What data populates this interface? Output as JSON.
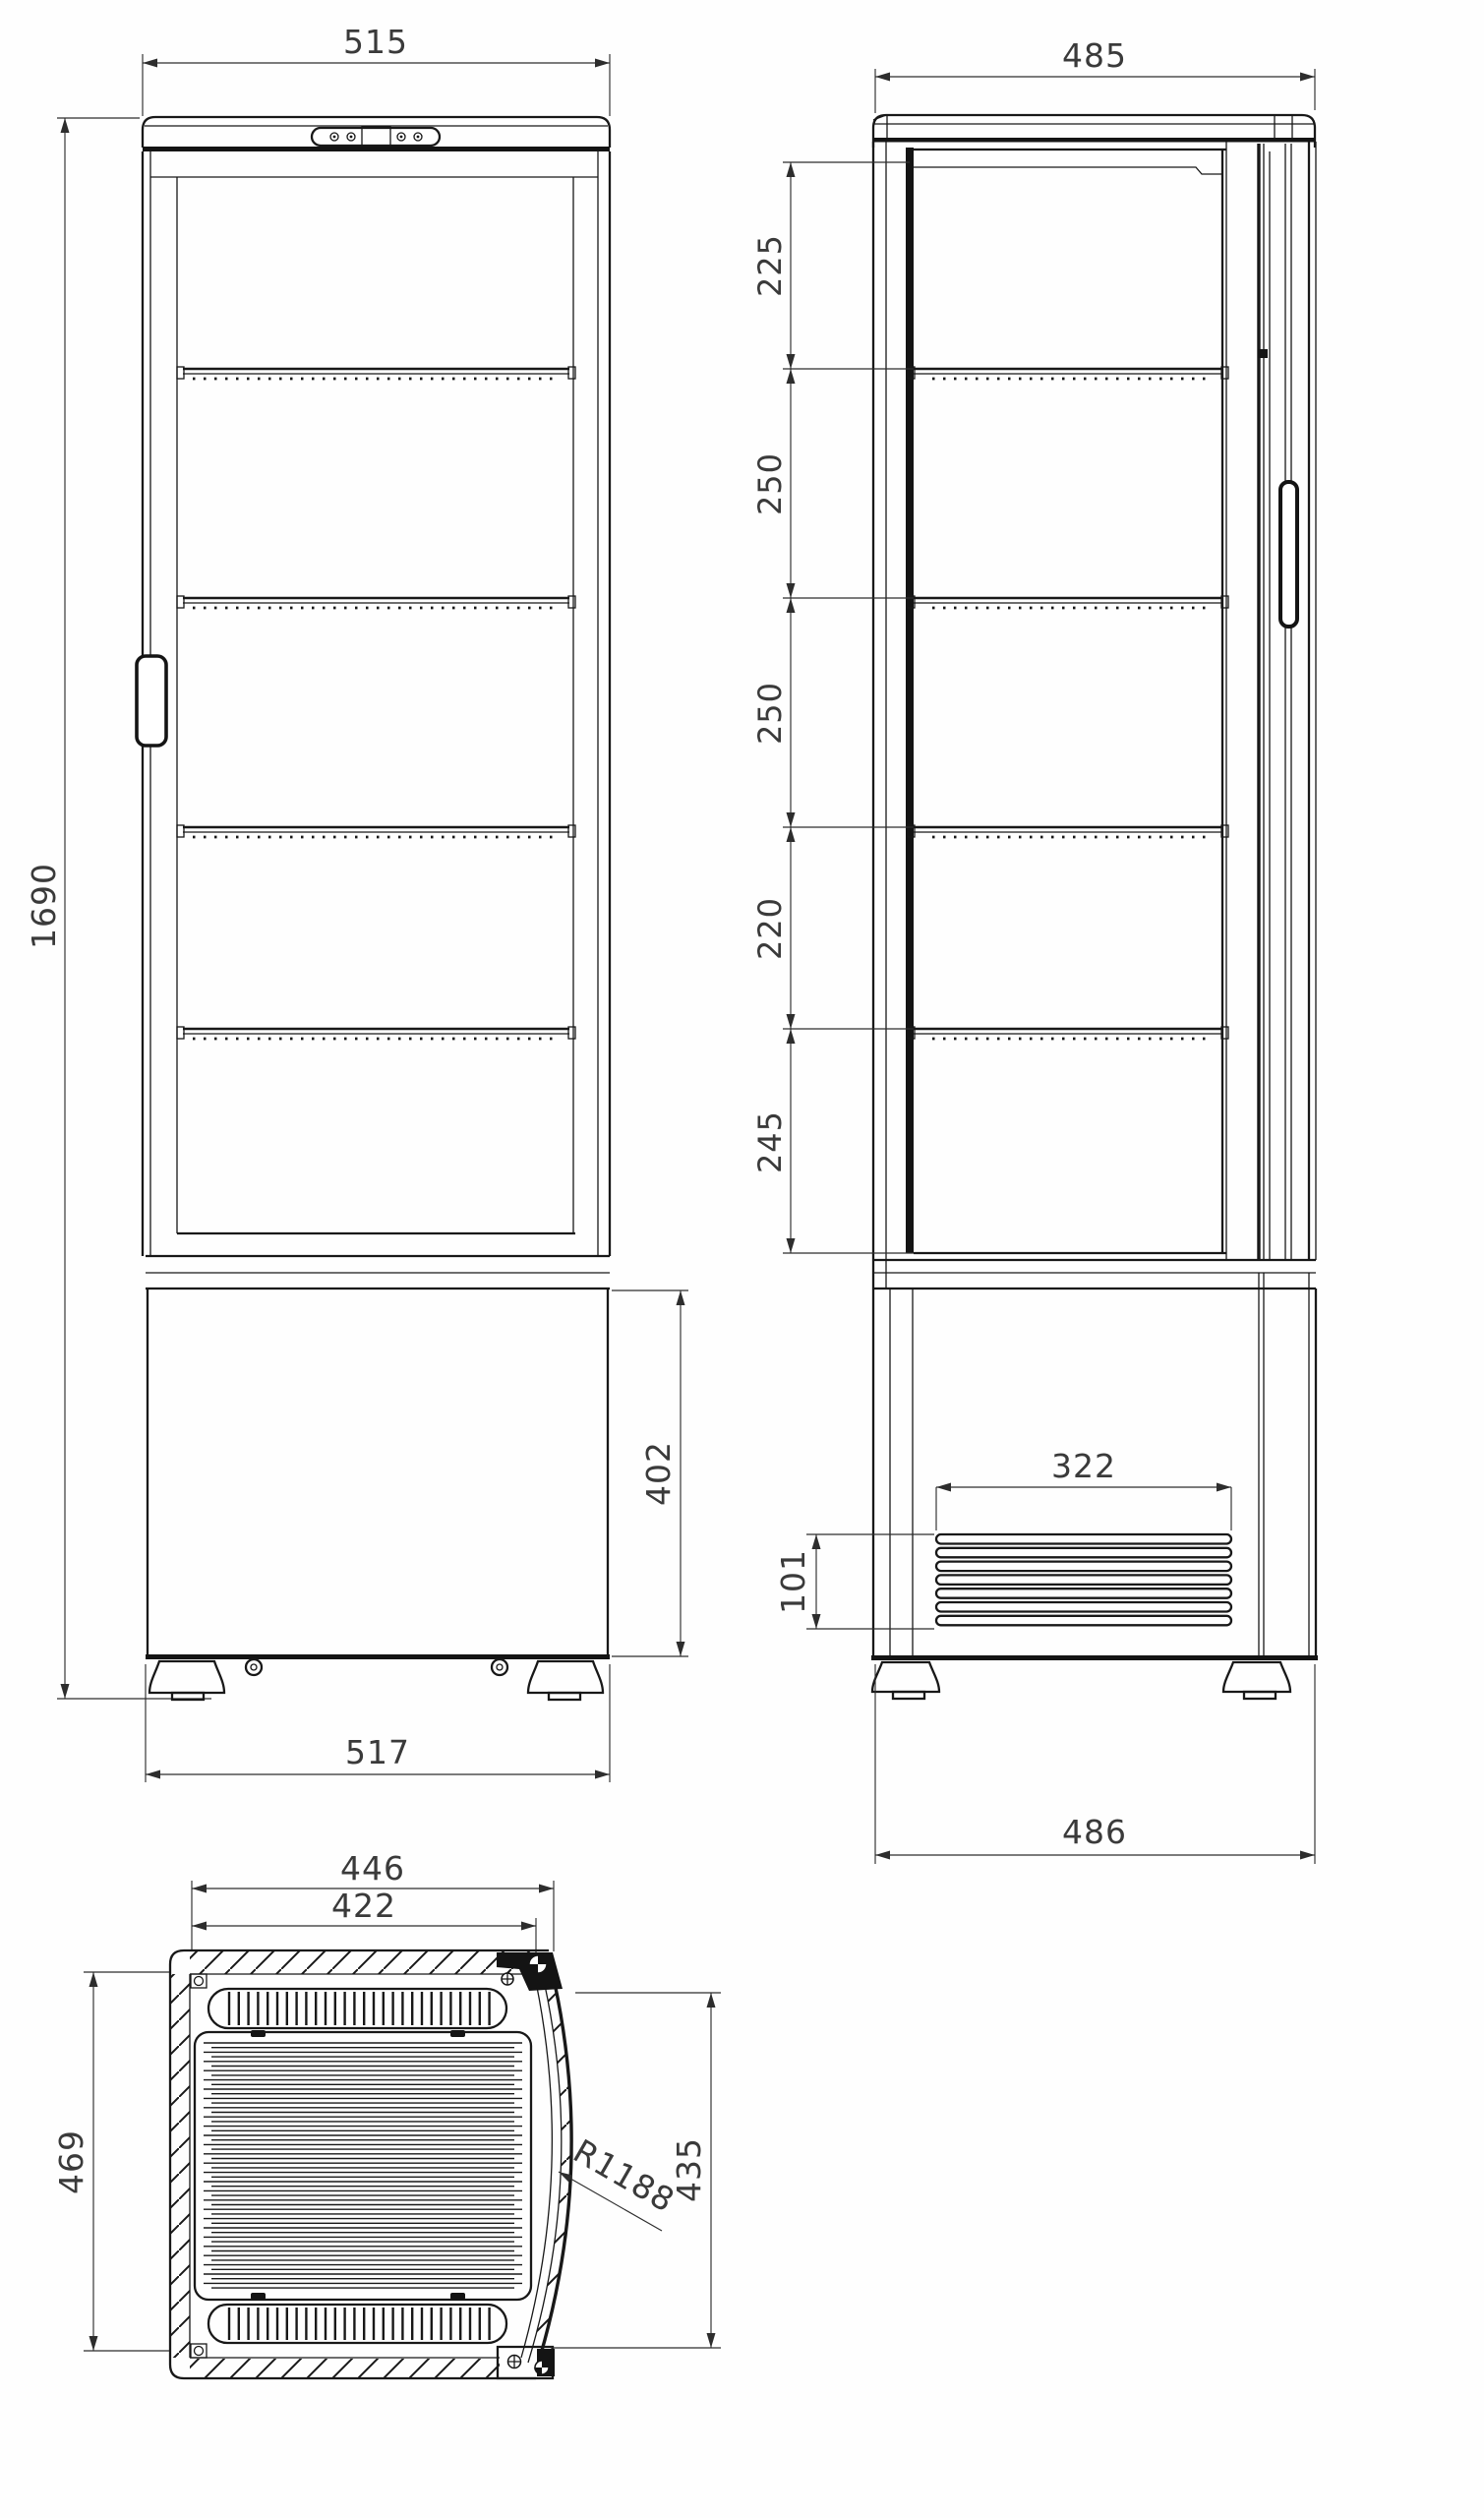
{
  "drawing": {
    "type": "dimensioned technical drawing",
    "subject": "upright curved-glass display cooler, three orthographic views",
    "line_color": "#181818",
    "background": "#fefefe"
  },
  "views": {
    "front": {
      "label": "front elevation",
      "dims": {
        "top_width": "515",
        "total_height": "1690",
        "base_height": "402",
        "bottom_width": "517"
      }
    },
    "side": {
      "label": "side elevation",
      "dims": {
        "top_depth": "485",
        "shelf_pitch": [
          "225",
          "250",
          "250",
          "220",
          "245"
        ],
        "vent_width": "322",
        "vent_height": "101",
        "bottom_depth": "486"
      }
    },
    "plan": {
      "label": "plan view",
      "dims": {
        "outer_width": "446",
        "inner_width": "422",
        "depth_left": "469",
        "depth_right": "435",
        "front_glass_radius": "R1188"
      }
    }
  }
}
